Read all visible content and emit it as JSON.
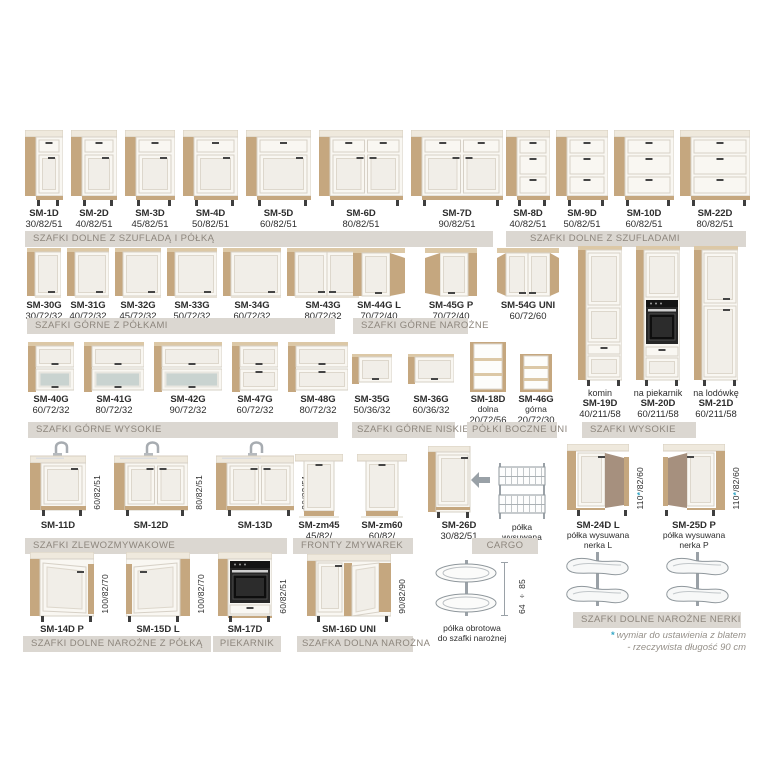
{
  "colors": {
    "wood": "#c5a77f",
    "wood_light": "#dcc8a6",
    "counter": "#efe9dd",
    "counter_edge": "#d7cec0",
    "front": "#f9f7f2",
    "front_stroke": "#d6d0c6",
    "panel": "#f1eee8",
    "panel_stroke": "#ddd7cc",
    "handle": "#454545",
    "glass": "#c9d3d0",
    "brown": "#a6907e",
    "wire": "#8f979c",
    "bar_bg": "#dbd7d1",
    "bar_text": "#8d867d",
    "accent": "#35a7c6",
    "note": "#96918a"
  },
  "groups": [
    {
      "id": "g1",
      "label": "SZAFKI DOLNE Z SZUFLADĄ I PÓŁKĄ",
      "items": [
        {
          "name": "SM-1D",
          "dims": "30/82/51",
          "type": "base_door"
        },
        {
          "name": "SM-2D",
          "dims": "40/82/51",
          "type": "base_door"
        },
        {
          "name": "SM-3D",
          "dims": "45/82/51",
          "type": "base_door"
        },
        {
          "name": "SM-4D",
          "dims": "50/82/51",
          "type": "base_door"
        },
        {
          "name": "SM-5D",
          "dims": "60/82/51",
          "type": "base_door"
        },
        {
          "name": "SM-6D",
          "dims": "80/82/51",
          "type": "base_door2"
        },
        {
          "name": "SM-7D",
          "dims": "90/82/51",
          "type": "base_door2"
        }
      ]
    },
    {
      "id": "g2",
      "label": "SZAFKI DOLNE Z SZUFLADAMI",
      "items": [
        {
          "name": "SM-8D",
          "dims": "40/82/51",
          "type": "base_drawers3"
        },
        {
          "name": "SM-9D",
          "dims": "50/82/51",
          "type": "base_drawers3"
        },
        {
          "name": "SM-10D",
          "dims": "60/82/51",
          "type": "base_drawers3"
        },
        {
          "name": "SM-22D",
          "dims": "80/82/51",
          "type": "base_drawers3"
        }
      ]
    },
    {
      "id": "g3",
      "label": "SZAFKI GÓRNE Z PÓŁKAMI",
      "items": [
        {
          "name": "SM-30G",
          "dims": "30/72/32",
          "type": "upper_door"
        },
        {
          "name": "SM-31G",
          "dims": "40/72/32",
          "type": "upper_door"
        },
        {
          "name": "SM-32G",
          "dims": "45/72/32",
          "type": "upper_door"
        },
        {
          "name": "SM-33G",
          "dims": "50/72/32",
          "type": "upper_door"
        },
        {
          "name": "SM-34G",
          "dims": "60/72/32",
          "type": "upper_door"
        },
        {
          "name": "SM-43G",
          "dims": "80/72/32",
          "type": "upper_door2"
        }
      ]
    },
    {
      "id": "g4",
      "label": "SZAFKI GÓRNE NAROŻNE",
      "items": [
        {
          "name": "SM-44G L",
          "dims": "70/72/40",
          "type": "upper_corner_L"
        },
        {
          "name": "SM-45G P",
          "dims": "70/72/40",
          "type": "upper_corner_P"
        },
        {
          "name": "SM-54G UNI",
          "dims": "60/72/60",
          "type": "upper_corner_uni"
        }
      ]
    },
    {
      "id": "g5",
      "label": "SZAFKI GÓRNE WYSOKIE",
      "items": [
        {
          "name": "SM-40G",
          "dims": "60/72/32",
          "type": "upper_flap_glass"
        },
        {
          "name": "SM-41G",
          "dims": "80/72/32",
          "type": "upper_flap_glass"
        },
        {
          "name": "SM-42G",
          "dims": "90/72/32",
          "type": "upper_flap_glass"
        },
        {
          "name": "SM-47G",
          "dims": "60/72/32",
          "type": "upper_flap2"
        },
        {
          "name": "SM-48G",
          "dims": "80/72/32",
          "type": "upper_flap2"
        }
      ]
    },
    {
      "id": "g6",
      "label": "SZAFKI GÓRNE NISKIE",
      "items": [
        {
          "name": "SM-35G",
          "dims": "50/36/32",
          "type": "upper_flap1"
        },
        {
          "name": "SM-36G",
          "dims": "60/36/32",
          "type": "upper_flap1"
        }
      ]
    },
    {
      "id": "g7",
      "label": "PÓŁKI BOCZNE UNI",
      "items": [
        {
          "name": "SM-18D",
          "sub": [
            "dolna"
          ],
          "dims": "20/72/56",
          "type": "shelf_open_tall"
        },
        {
          "name": "SM-46G",
          "sub": [
            "górna"
          ],
          "dims": "20/72/30",
          "type": "shelf_open_short"
        }
      ]
    },
    {
      "id": "g8",
      "label": "SZAFKI WYSOKIE",
      "items": [
        {
          "top": "komin",
          "name": "SM-19D",
          "dims": "40/211/58",
          "type": "tall_komin"
        },
        {
          "top": "na piekarnik",
          "name": "SM-20D",
          "dims": "60/211/58",
          "type": "tall_oven"
        },
        {
          "top": "na lodówkę",
          "name": "SM-21D",
          "dims": "60/211/58",
          "type": "tall_fridge"
        }
      ]
    },
    {
      "id": "g9",
      "label": "SZAFKI ZLEWOZMYWAKOWE",
      "items": [
        {
          "name": "SM-11D",
          "vdim": "60/82/51",
          "type": "sink1"
        },
        {
          "name": "SM-12D",
          "vdim": "80/82/51",
          "type": "sink2"
        },
        {
          "name": "SM-13D",
          "vdim": "90/82/51",
          "type": "sink2"
        }
      ]
    },
    {
      "id": "g10",
      "label": "FRONTY ZMYWAREK",
      "items": [
        {
          "name": "SM-zm45",
          "dims": "45/82/",
          "type": "dw_front"
        },
        {
          "name": "SM-zm60",
          "dims": "60/82/",
          "type": "dw_front"
        }
      ]
    },
    {
      "id": "g11",
      "label": "CARGO",
      "items": [
        {
          "name": "SM-26D",
          "dims": "30/82/51",
          "type": "cargo_door"
        },
        {
          "sub": [
            "półka",
            "wysuwana"
          ],
          "type": "cargo_basket"
        }
      ]
    },
    {
      "id": "g12",
      "label": "SZAFKI DOLNE NAROŻNE NERKI",
      "items": [
        {
          "name": "SM-24D L",
          "sub": [
            "półka wysuwana",
            "nerka L"
          ],
          "vdim": "110*/82/60",
          "type": "nerka_L"
        },
        {
          "name": "SM-25D P",
          "sub": [
            "półka wysuwana",
            "nerka P"
          ],
          "vdim": "110*/82/60",
          "type": "nerka_P"
        }
      ]
    },
    {
      "id": "g12b",
      "label": "",
      "items": [
        {
          "type": "nerka_basket"
        },
        {
          "type": "nerka_basket"
        }
      ]
    },
    {
      "id": "g13",
      "label": "SZAFKI DOLNE NAROŻNE Z PÓŁKĄ",
      "items": [
        {
          "name": "SM-14D P",
          "vdim": "100/82/70",
          "type": "corner_base_P"
        },
        {
          "name": "SM-15D L",
          "vdim": "100/82/70",
          "type": "corner_base_L"
        }
      ]
    },
    {
      "id": "g14",
      "label": "PIEKARNIK",
      "items": [
        {
          "name": "SM-17D",
          "vdim": "60/82/51",
          "type": "oven_base"
        }
      ]
    },
    {
      "id": "g15",
      "label": "SZAFKA DOLNA NAROŻNA",
      "items": [
        {
          "name": "SM-16D UNI",
          "vdim": "90/82/90",
          "type": "corner_uni"
        }
      ]
    },
    {
      "id": "g16",
      "label": "",
      "items": [
        {
          "sub": [
            "półka obrotowa",
            "do szafki narożnej"
          ],
          "vdim": "64 ÷ 85",
          "type": "carousel"
        }
      ]
    }
  ],
  "footnote": {
    "star": "*",
    "lines": [
      "wymiar do ustawienia z blatem",
      "- rzeczywista długość 90 cm"
    ]
  }
}
